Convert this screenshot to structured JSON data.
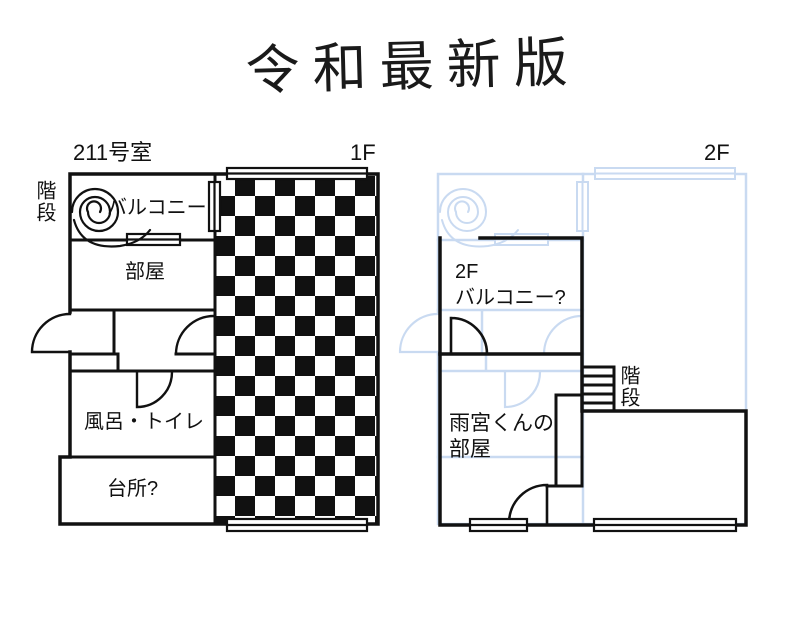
{
  "title": {
    "text": "令和最新版"
  },
  "colors": {
    "ink": "#111111",
    "ghost_blue": "#c9daf1",
    "background": "#ffffff"
  },
  "floor1": {
    "room_number": "211号室",
    "floor_label": "1F",
    "stairs_label": "階段",
    "balcony_label": "バルコニー",
    "room_label": "部屋",
    "bath_toilet_label": "風呂・トイレ",
    "kitchen_label": "台所?"
  },
  "floor2": {
    "floor_label": "2F",
    "balcony_line1": "2F",
    "balcony_line2": "バルコニー?",
    "amamiya_room_line1": "雨宮くんの",
    "amamiya_room_line2": "部屋",
    "stairs_label": "階段"
  }
}
